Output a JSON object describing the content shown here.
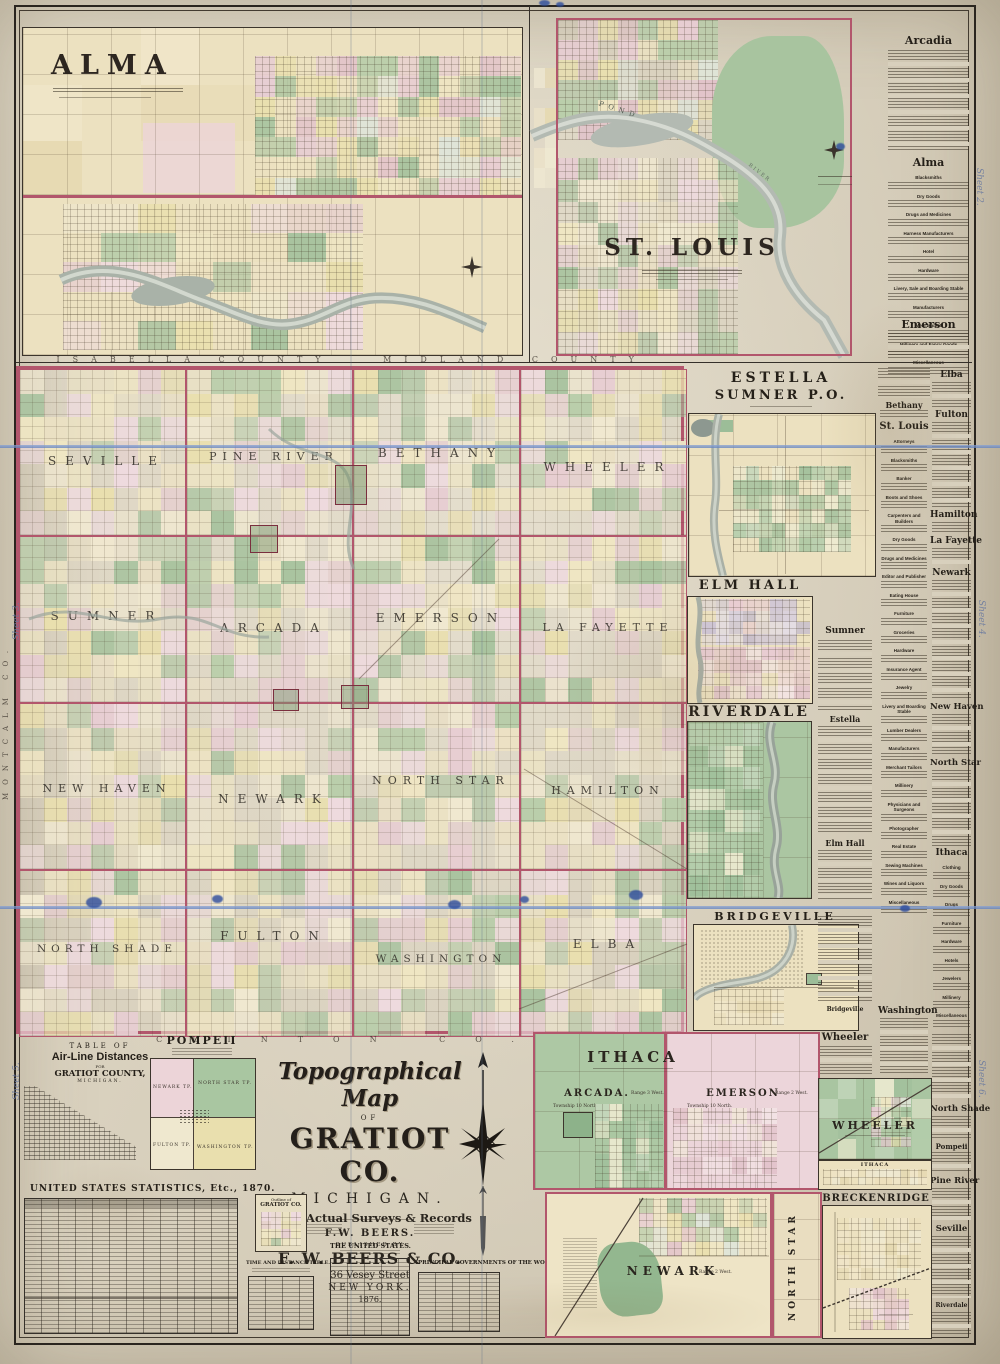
{
  "colors": {
    "paper": "#d8d0bd",
    "map_cream": "#ece1c0",
    "border_red": "#b2566c",
    "fold_blue": "#5d7fc0",
    "ink_blue": "#2d4c9d",
    "river": "#a9b2a8",
    "main": [
      "#a9c39f",
      "#b9cdaa",
      "#e7cdd2",
      "#eedade",
      "#e9dfae",
      "#efe6c3",
      "#ece2c4",
      "#f0e8d0"
    ],
    "green": [
      "#9fbf9b",
      "#aac6a2",
      "#b7cfae",
      "#c3d6bb",
      "#ecead0"
    ],
    "pink": [
      "#e8ccd2",
      "#eed8dc",
      "#f2e2e4",
      "#e2c3ca",
      "#f0e4d8"
    ],
    "cream": [
      "#ece0bd",
      "#f0e6c9",
      "#e6d9b2",
      "#efe9d2"
    ],
    "village": [
      "#a9c39f",
      "#e7cdd2",
      "#e9dfae",
      "#efe6c3",
      "#dfe4d8",
      "#e2c3ca",
      "#b9cdaa"
    ],
    "lavender": [
      "#cfc6d6",
      "#d8d0dc",
      "#c5bccd",
      "#e3dce6",
      "#e8ccd2"
    ]
  },
  "alma": {
    "title": "ALMA"
  },
  "st_louis_inset": {
    "title": "ST. LOUIS",
    "pond": "POND",
    "river": "RIVER"
  },
  "estella": {
    "line1": "ESTELLA",
    "line2": "SUMNER P.O."
  },
  "elm_hall": {
    "title": "ELM HALL"
  },
  "riverdale_inset": {
    "title": "RIVERDALE"
  },
  "bridgeville_inset": {
    "title": "BRIDGEVILLE"
  },
  "ithaca_inset": {
    "title": "ITHACA",
    "arcada": "ARCADA.",
    "emerson": "EMERSON",
    "twp": "Township 10 North.",
    "r3": "Range 3 West.",
    "r2": "Range 2 West."
  },
  "newark_inset": {
    "label": "NEWARK",
    "range": "Range 2 West.",
    "strip": "NORTH STAR"
  },
  "wheeler_inset": {
    "title": "WHEELER"
  },
  "ithaca_strip": {
    "title": "ITHACA"
  },
  "breckenridge_inset": {
    "title": "BRECKENRIDGE"
  },
  "pompeii_inset": {
    "title": "POMPEII",
    "nw": "NEWARK TP.",
    "ne": "NORTH STAR TP.",
    "sw": "FULTON TP.",
    "se": "WASHINGTON TP."
  },
  "main_map": {
    "townships": [
      "SEVILLE",
      "PINE RIVER",
      "BETHANY",
      "WHEELER",
      "SUMNER",
      "ARCADA",
      "EMERSON",
      "LA FAYETTE",
      "NEW HAVEN",
      "NEWARK",
      "NORTH STAR",
      "HAMILTON",
      "NORTH SHADE",
      "FULTON",
      "WASHINGTON",
      "ELBA"
    ],
    "counties": {
      "top_left": "ISABELLA COUNTY",
      "top_right": "MIDLAND COUNTY",
      "bottom": "CLINTON CO.",
      "left": "MONTCALM CO."
    }
  },
  "title_block": {
    "l1": "Topographical Map",
    "l2": "OF",
    "l3": "GRATIOT CO.",
    "l4": "MICHIGAN.",
    "l5": "From Actual Surveys & Records",
    "l6": "F.W. BEERS.",
    "l7": "PUBLISHED BY",
    "l8": "F. W. BEERS & CO.",
    "l9": "36 Vesey Street",
    "l10": "NEW YORK.",
    "l11": "1876."
  },
  "tables": {
    "air1": "TABLE OF",
    "air2": "Air-Line Distances",
    "air3": "FOR",
    "air4": "GRATIOT COUNTY,",
    "air5": "MICHIGAN.",
    "us_stats": "UNITED STATES STATISTICS, Etc., 1870.",
    "time": "TIME AND DISTANCE TABLE.",
    "us": "THE UNITED STATES.",
    "world": "PRINCIPAL GOVERNMENTS OF THE WORLD.",
    "outline1": "Outline of",
    "outline2": "GRATIOT CO."
  },
  "directory": {
    "arcadia": "Arcadia",
    "alma": "Alma",
    "emerson": "Emerson",
    "bethany": "Bethany",
    "st_louis": "St. Louis",
    "elba": "Elba",
    "fulton": "Fulton",
    "hamilton": "Hamilton",
    "la_fayette": "La Fayette",
    "newark": "Newark",
    "sumner": "Sumner",
    "estella": "Estella",
    "elm_hall": "Elm Hall",
    "new_haven": "New Haven",
    "north_star": "North Star",
    "ithaca": "Ithaca",
    "washington": "Washington",
    "bridgeville": "Bridgeville",
    "wheeler": "Wheeler",
    "north_shade": "North Shade",
    "pompeii": "Pompeii",
    "pine_river": "Pine River",
    "seville": "Seville",
    "riverdale": "Riverdale",
    "alma_sections": [
      "Blacksmiths",
      "Dry Goods",
      "Drugs and Medicines",
      "Harness Manufacturers",
      "Hotel",
      "Hardware",
      "Livery, Sale and Boarding Stable",
      "Manufacturers",
      "Meat Market",
      "Millinery and Fancy Goods",
      "Miscellaneous"
    ],
    "st_louis_sections": [
      "Attorneys",
      "Blacksmiths",
      "Banker",
      "Boots and Shoes",
      "Carpenters and Builders",
      "Dry Goods",
      "Drugs and Medicines",
      "Editor and Publisher",
      "Eating House",
      "Furniture",
      "Groceries",
      "Hardware",
      "Insurance Agent",
      "Jewelry",
      "Livery and Boarding Stable",
      "Lumber Dealers",
      "Manufacturers",
      "Merchant Tailors",
      "Millinery",
      "Physicians and Surgeons",
      "Photographer",
      "Real Estate",
      "Sewing Machines",
      "Wines and Liquors",
      "Miscellaneous"
    ],
    "ithaca_sections": [
      "Clothing",
      "Dry Goods",
      "Drugs",
      "Furniture",
      "Hardware",
      "Hotels",
      "Jewelers",
      "Millinery",
      "Miscellaneous",
      "Physicians",
      "Photographer",
      "Real Estate"
    ]
  },
  "margin_notes": [
    "Sheet 2.",
    "Sheet 3.",
    "Sheet 4.",
    "Sheet 5.",
    "Sheet 6."
  ]
}
